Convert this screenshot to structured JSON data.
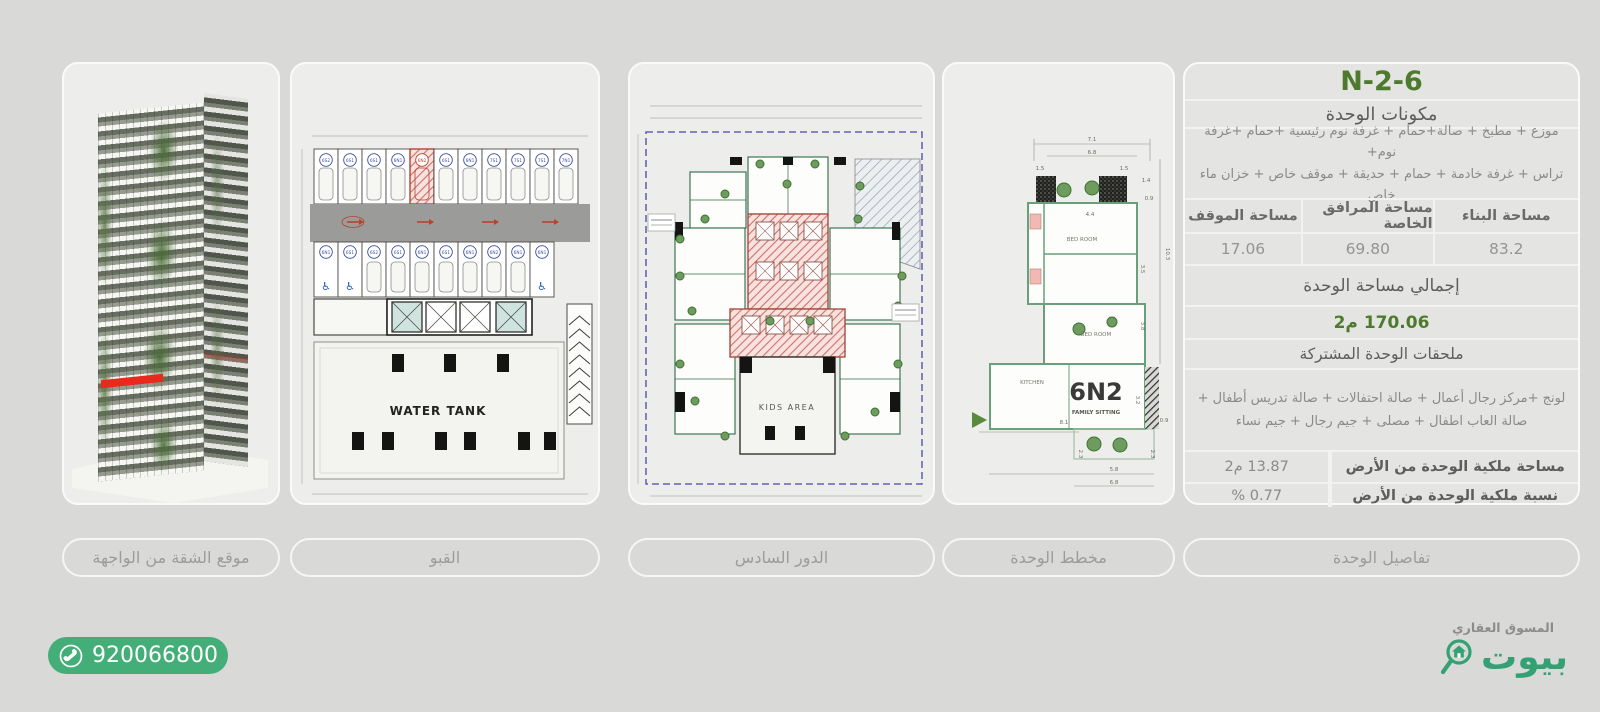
{
  "panels": {
    "building": {
      "caption": "موقع الشقة من الواجهة"
    },
    "basement": {
      "caption": "القبو",
      "water_tank_label": "WATER TANK",
      "highlight_index": 4,
      "stalls_top": [
        "6S2",
        "6S1",
        "6S1",
        "6N1",
        "6N2",
        "6S1",
        "6N1",
        "7S1",
        "7S1",
        "7S1",
        "7N1"
      ],
      "stalls_bottom": [
        "6N1",
        "6S1",
        "6S2",
        "6S1",
        "6N1",
        "6S1",
        "6N1",
        "6N2",
        "6N1",
        "6N1"
      ],
      "disabled_indices": [
        0,
        1,
        9
      ]
    },
    "sixth_floor": {
      "caption": "الدور السادس",
      "kids_area_label": "KIDS AREA"
    },
    "unit_plan": {
      "caption": "مخطط الوحدة",
      "unit_code": "6N2",
      "family_sitting": "FAMILY SITTING",
      "bedroom1": "BED ROOM",
      "bedroom2": "BED ROOM",
      "kitchen": "KITCHEN",
      "dims": [
        "7.1",
        "6.8",
        "1.5",
        "1.5",
        "1.4",
        "0.9",
        "4.4",
        "10.3",
        "3.5",
        "3.8",
        "8.1",
        "3.2",
        "5.8",
        "6.8",
        "2.3",
        "2.3",
        "0.9"
      ]
    },
    "details": {
      "caption": "تفاصيل الوحدة"
    }
  },
  "details": {
    "title": "6-N-2",
    "components_header": "مكونات الوحدة",
    "components_line1": "موزع + مطبخ + صالة+حمام + غرفة نوم رئيسية +حمام +غرفة نوم+",
    "components_line2": "تراس + غرفة خادمة + حمام + حديقة + موقف خاص + خزان ماء خاص",
    "areas": {
      "building_label": "مساحة البناء",
      "building_value": "83.2",
      "facilities_label": "مساحة المرافق الخاصة",
      "facilities_value": "69.80",
      "parking_label": "مساحة الموقف",
      "parking_value": "17.06"
    },
    "total_label": "إجمالي مساحة الوحدة",
    "total_value": "170.06 م2",
    "shared_header": "ملحقات الوحدة المشتركة",
    "shared_line1": "لونج +مركز رجال أعمال + صالة احتفالات + صالة تدريس أطفال +",
    "shared_line2": "صالة العاب اطفال + مصلى + جيم رجال + جيم نساء",
    "land_area_label": "مساحة ملكية الوحدة من الأرض",
    "land_area_value": "13.87 م2",
    "land_pct_label": "نسبة ملكية الوحدة من الأرض",
    "land_pct_value": "0.77 %"
  },
  "footer": {
    "phone": "920066800",
    "marketer_label": "المسوق العقاري",
    "brand_name": "بيوت"
  },
  "colors": {
    "accent_green": "#4d7a2c",
    "pill_green": "#44ae78",
    "brand_green": "#33a173",
    "highlight_red": "#e8291c"
  }
}
